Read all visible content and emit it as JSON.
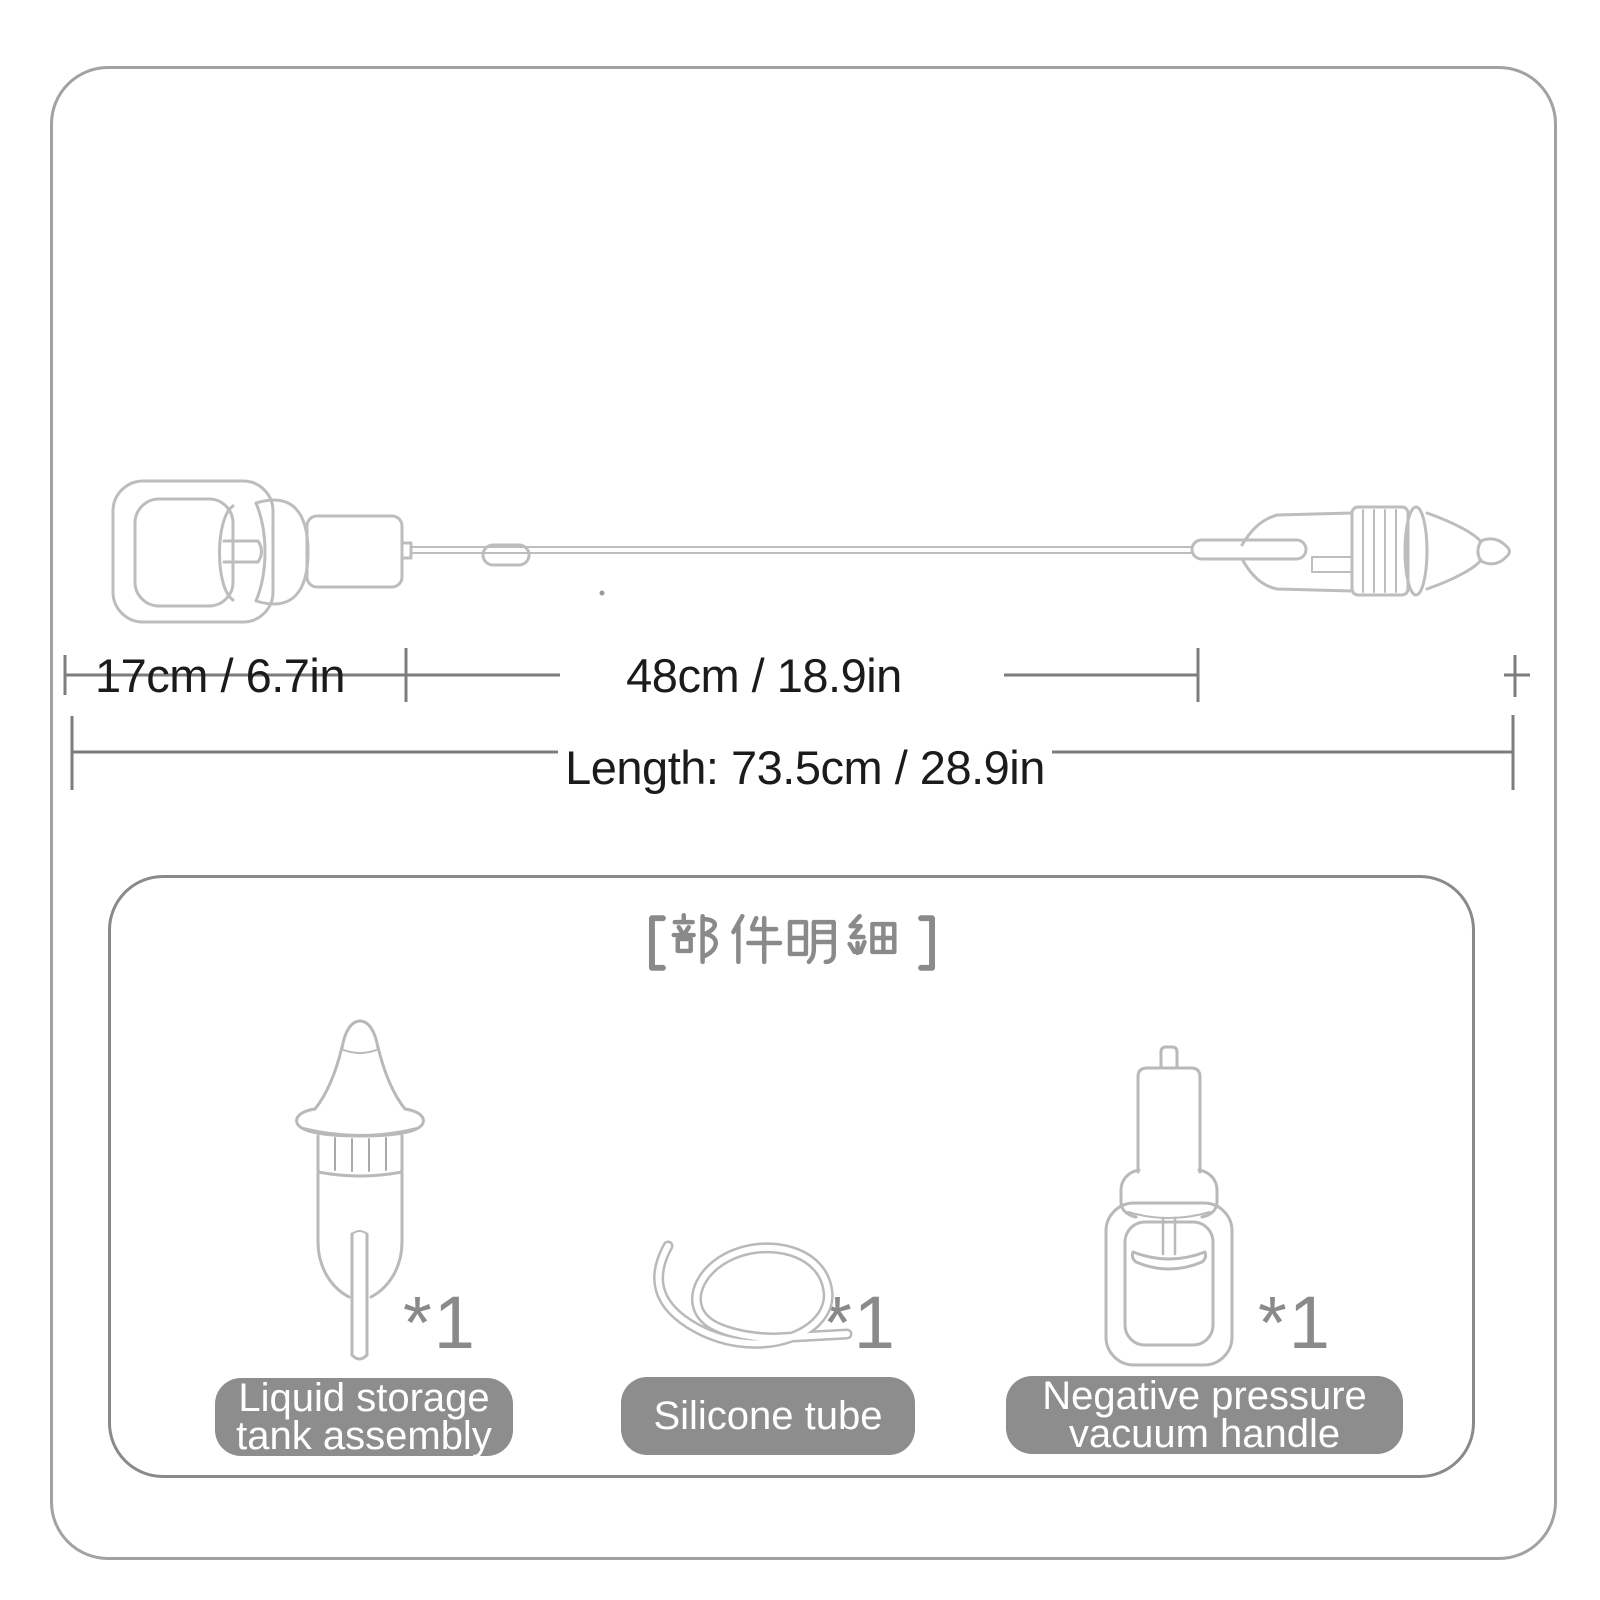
{
  "dimensions": {
    "handle_section": "17cm / 6.7in",
    "tube_section": "48cm / 18.9in",
    "total_length": "Length: 73.5cm / 28.9in"
  },
  "panel": {
    "title": "【部件明细】",
    "parts": [
      {
        "name": "Liquid storage\ntank assembly",
        "qty": "*1"
      },
      {
        "name": "Silicone tube",
        "qty": "*1"
      },
      {
        "name": "Negative pressure\nvacuum handle",
        "qty": "*1"
      }
    ]
  },
  "colors": {
    "background": "#ffffff",
    "outer_border": "#a2a2a2",
    "panel_border": "#8a8a8a",
    "line_art": "#bdbdbd",
    "dimension_lines": "#7d7d7d",
    "dimension_text": "#1b1b1b",
    "label_box": "#8d8d8d",
    "label_text": "#ffffff",
    "title_gray": "#8a8a8a"
  }
}
